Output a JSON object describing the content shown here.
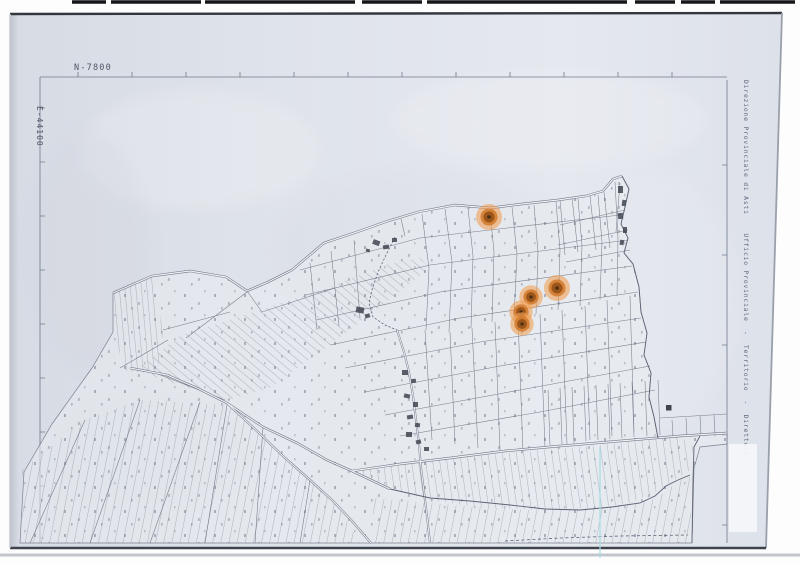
{
  "scan": {
    "top_coordinate_label": "N-7800",
    "left_coordinate_label": "E-44100",
    "side_annotation": "Direzione Provinciale di Asti    Ufficio Provinciale  -  Territorio  -  Direttore"
  },
  "markers": [
    {
      "x": 489,
      "y": 217,
      "r": 10
    },
    {
      "x": 557,
      "y": 288,
      "r": 10
    },
    {
      "x": 531,
      "y": 297,
      "r": 9
    },
    {
      "x": 521,
      "y": 312,
      "r": 9
    },
    {
      "x": 522,
      "y": 324,
      "r": 9
    }
  ],
  "colors": {
    "paper": "#dfe3ea",
    "ink": "#5b6273",
    "frame": "#6f7890",
    "annotation_text": "#5e6980",
    "highlight_halo": "#f0a056",
    "highlight_mid": "#d07828",
    "highlight_core": "#96511a",
    "reference_line_cyan": "#a8dbe0"
  }
}
